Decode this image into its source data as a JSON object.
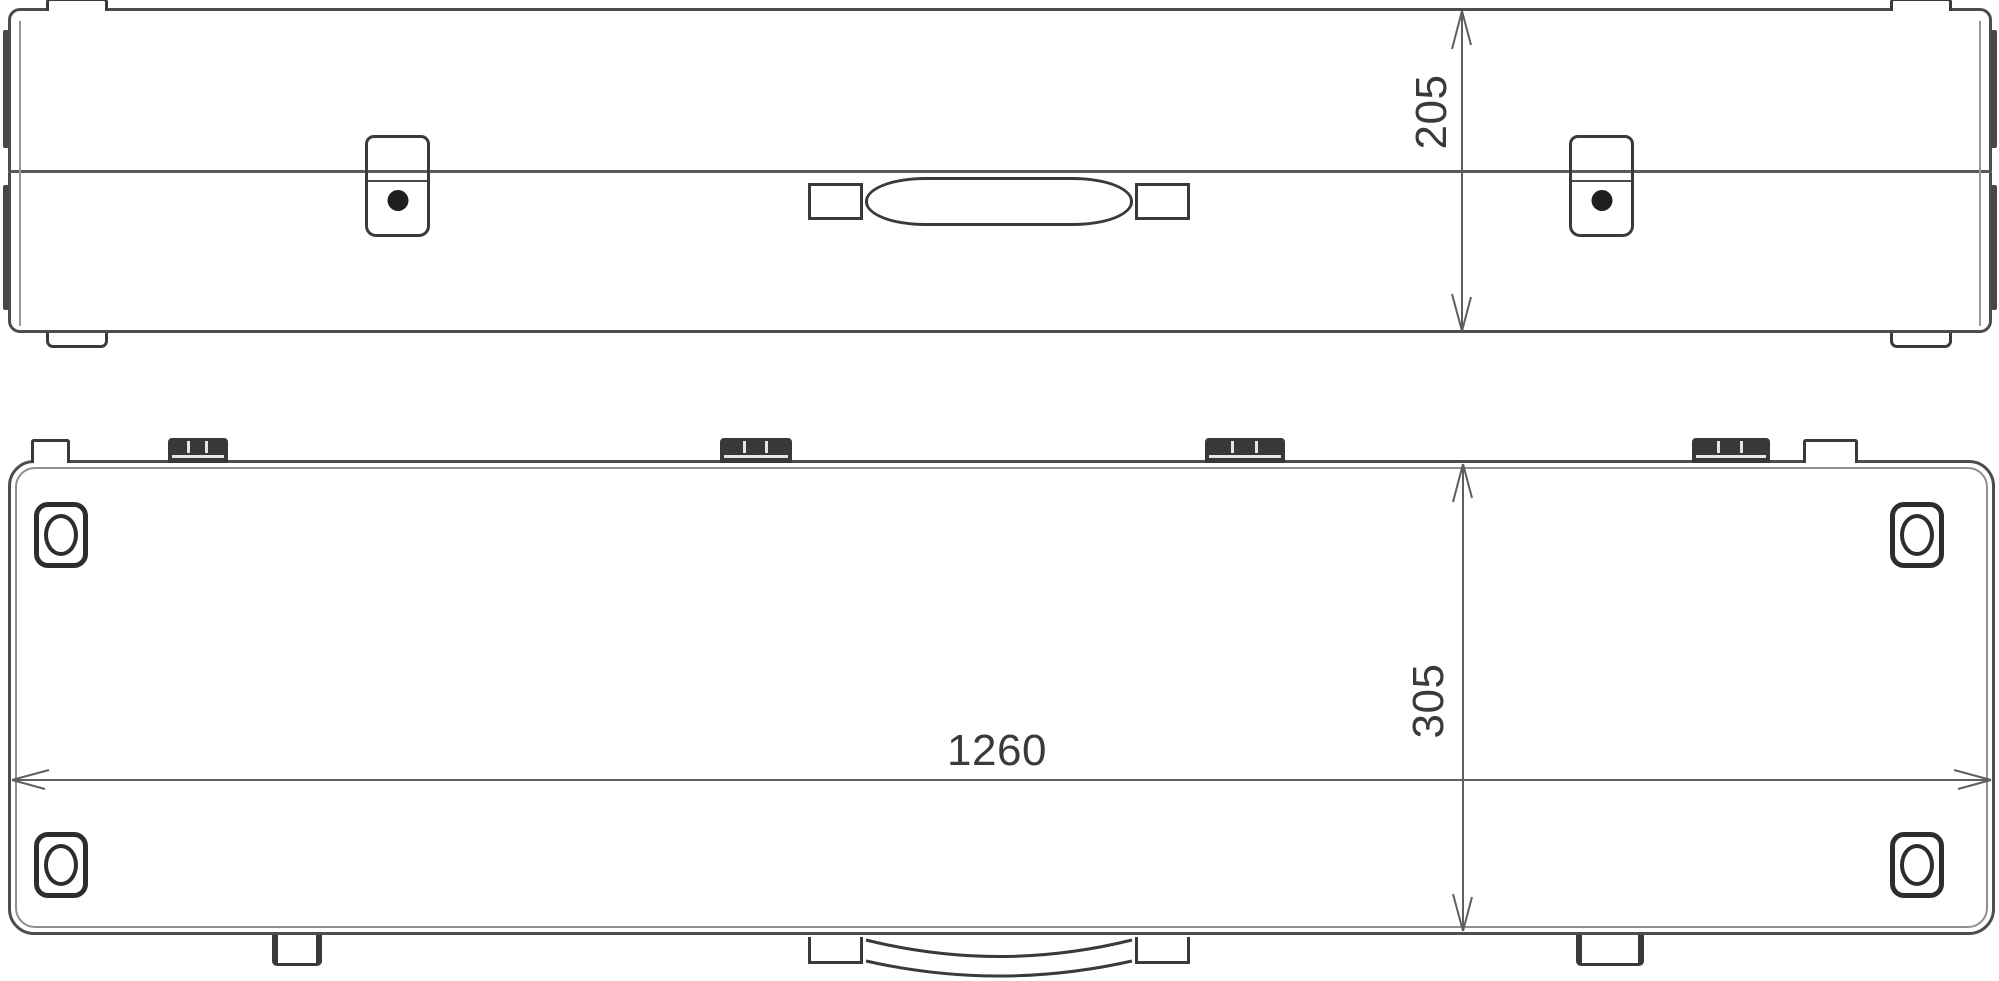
{
  "drawing": {
    "colors": {
      "background": "#ffffff",
      "outline": "#4d4d4d",
      "detail": "#3a3a3a",
      "dimension_line": "#5f5f5f",
      "text": "#3a3a3a"
    },
    "dimensions": {
      "case_height": "205",
      "case_depth": "305",
      "case_width": "1260"
    }
  }
}
